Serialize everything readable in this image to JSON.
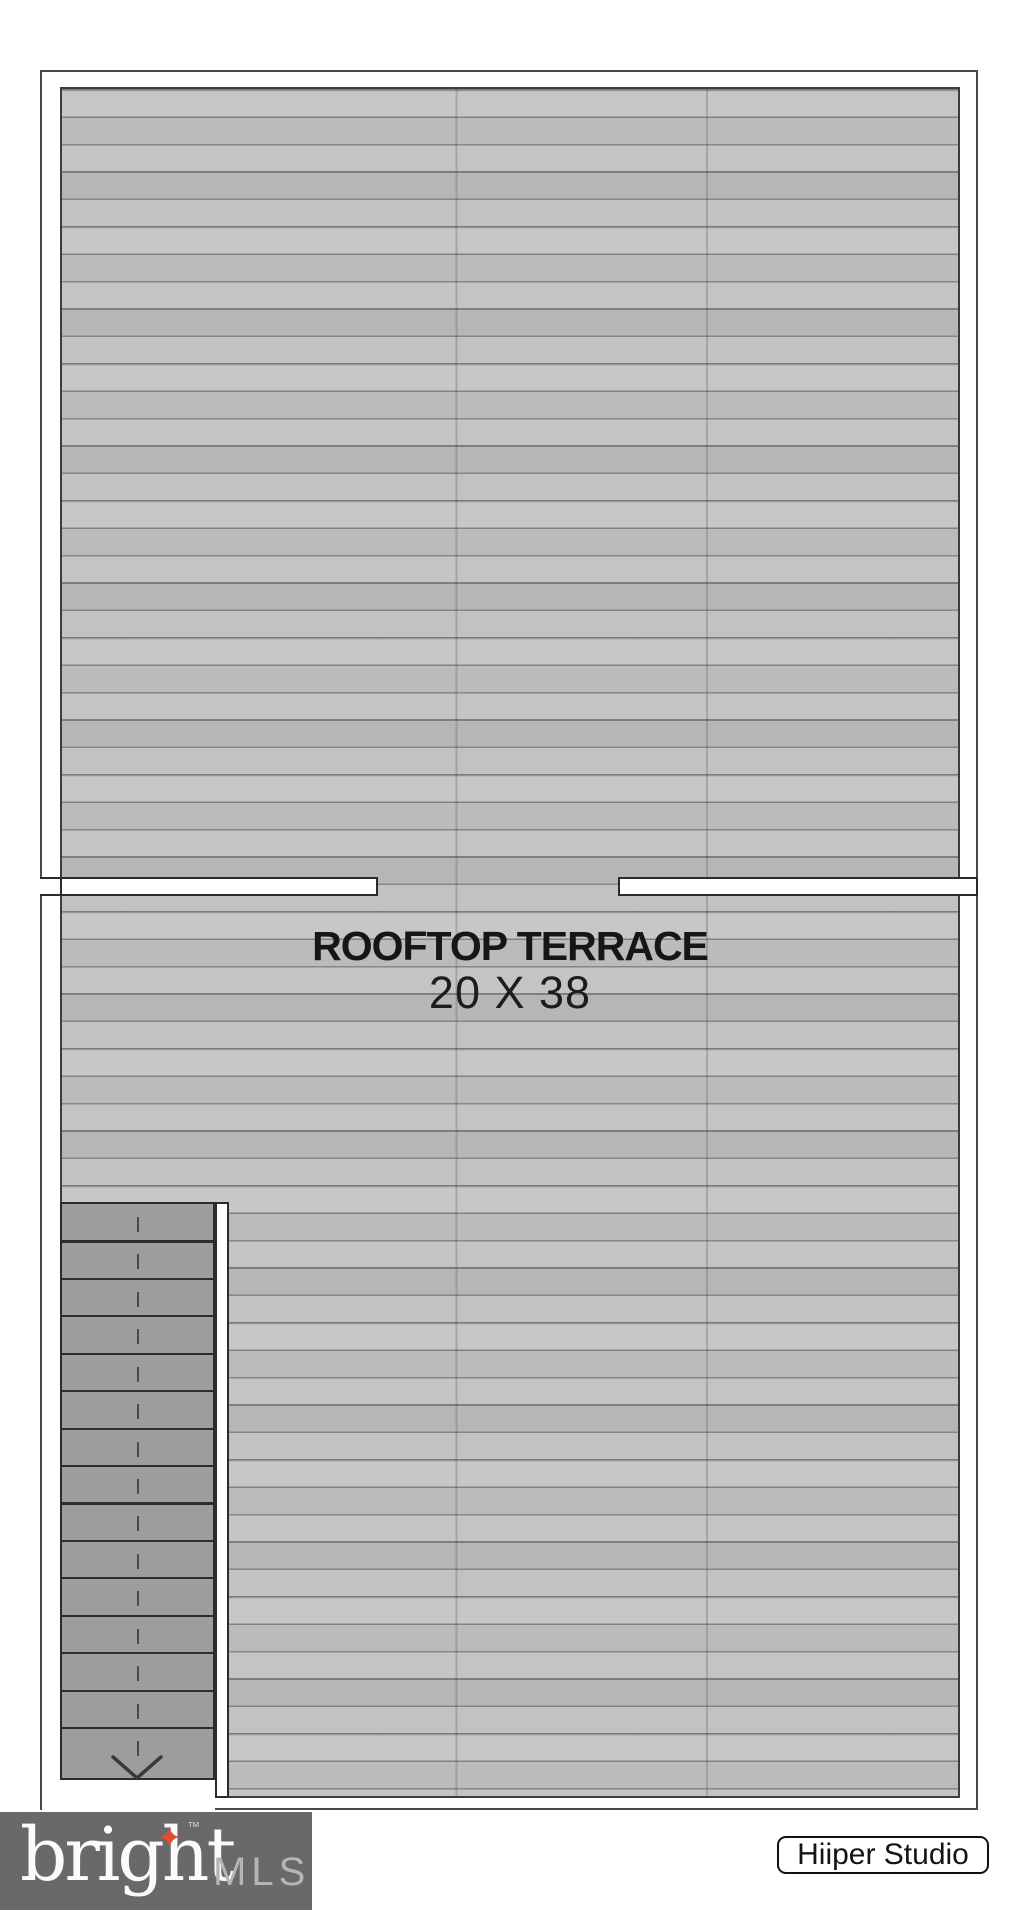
{
  "plan": {
    "room": {
      "label": "ROOFTOP TERRACE",
      "dimensions": "20 X 38"
    },
    "stairs": {
      "tread_count": 15,
      "direction": "down"
    }
  },
  "footer": {
    "brand_name": "bright",
    "brand_trademark": "™",
    "brand_star_glyph": "✦",
    "brand_suffix": "MLS",
    "studio_name": "Hiiper Studio"
  },
  "colors": {
    "deck_plank_light": "#c7c7c7",
    "deck_plank_dark": "#b6b6b6",
    "deck_joint_line": "#8a8a8a",
    "wall_line": "#2b2b2b",
    "stair_tread": "#9d9d9d",
    "footer_bg": "#696969",
    "brand_star": "#e0502f",
    "brand_mls_text": "#b5b5b5"
  }
}
